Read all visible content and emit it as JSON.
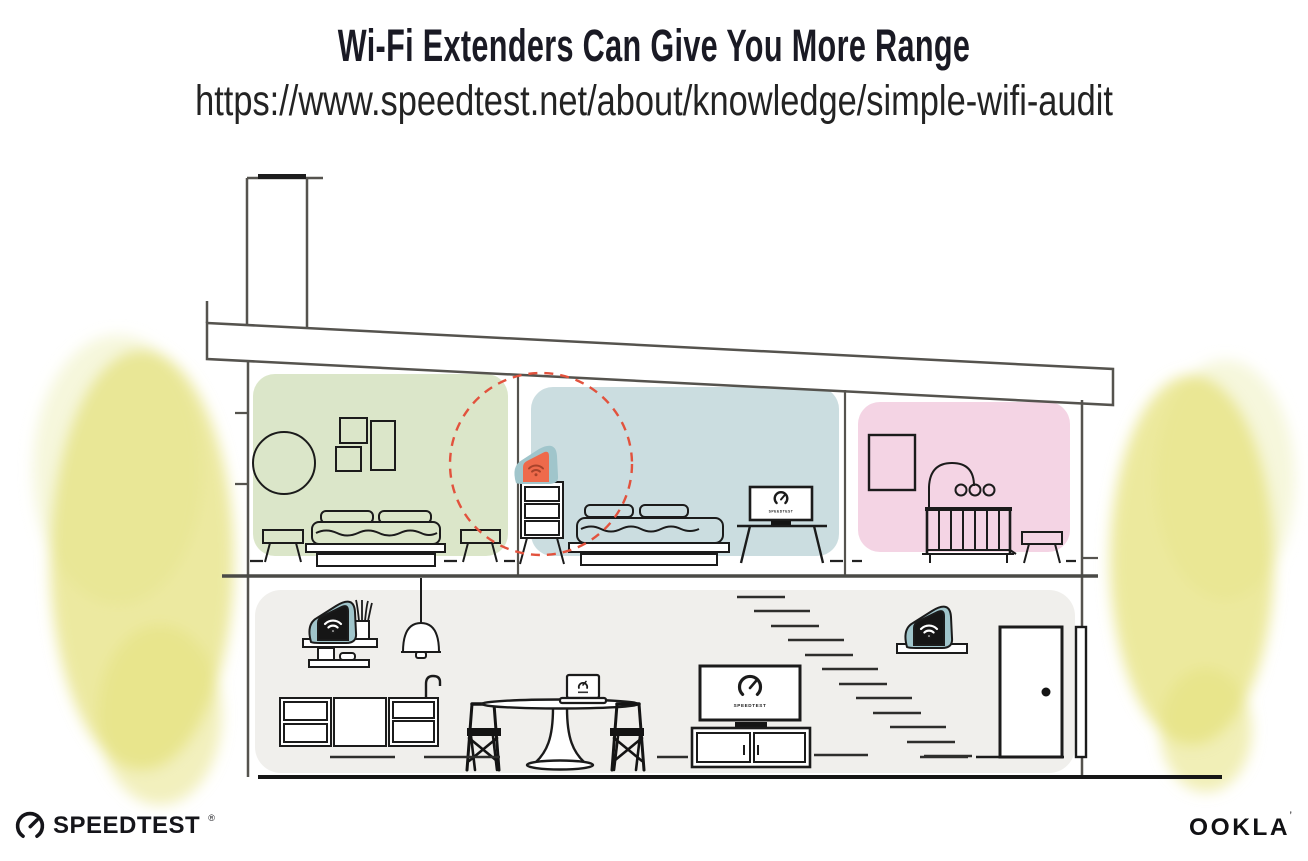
{
  "header": {
    "title": "Wi-Fi Extenders Can Give You More Range",
    "url": "https://www.speedtest.net/about/knowledge/simple-wifi-audit"
  },
  "illustration": {
    "tv_screen_label": "SPEEDTEST",
    "icons": [
      "wifi-icon",
      "speedtest-gauge-icon"
    ]
  },
  "footer": {
    "speedtest_wordmark": "SPEEDTEST",
    "reg_mark": "®",
    "ookla_wordmark": "OOKLA",
    "ookla_mark": "’"
  },
  "colors": {
    "room_green": "#dbe6c9",
    "room_blue": "#cbdde0",
    "room_pink": "#f4d4e4",
    "room_grey": "#f0efec",
    "device_teal": "#a0c5cb",
    "extender_orange": "#ee6a4b",
    "extender_wifi_dark": "#a8432b",
    "range_dashed_red": "#e2523d",
    "foliage_yellow": "#e5e17c",
    "foliage_yellow_light": "#eff0bf",
    "line_structure": "#55534e",
    "line_furniture": "#1a1a1a",
    "title_text": "#1a1a24"
  }
}
